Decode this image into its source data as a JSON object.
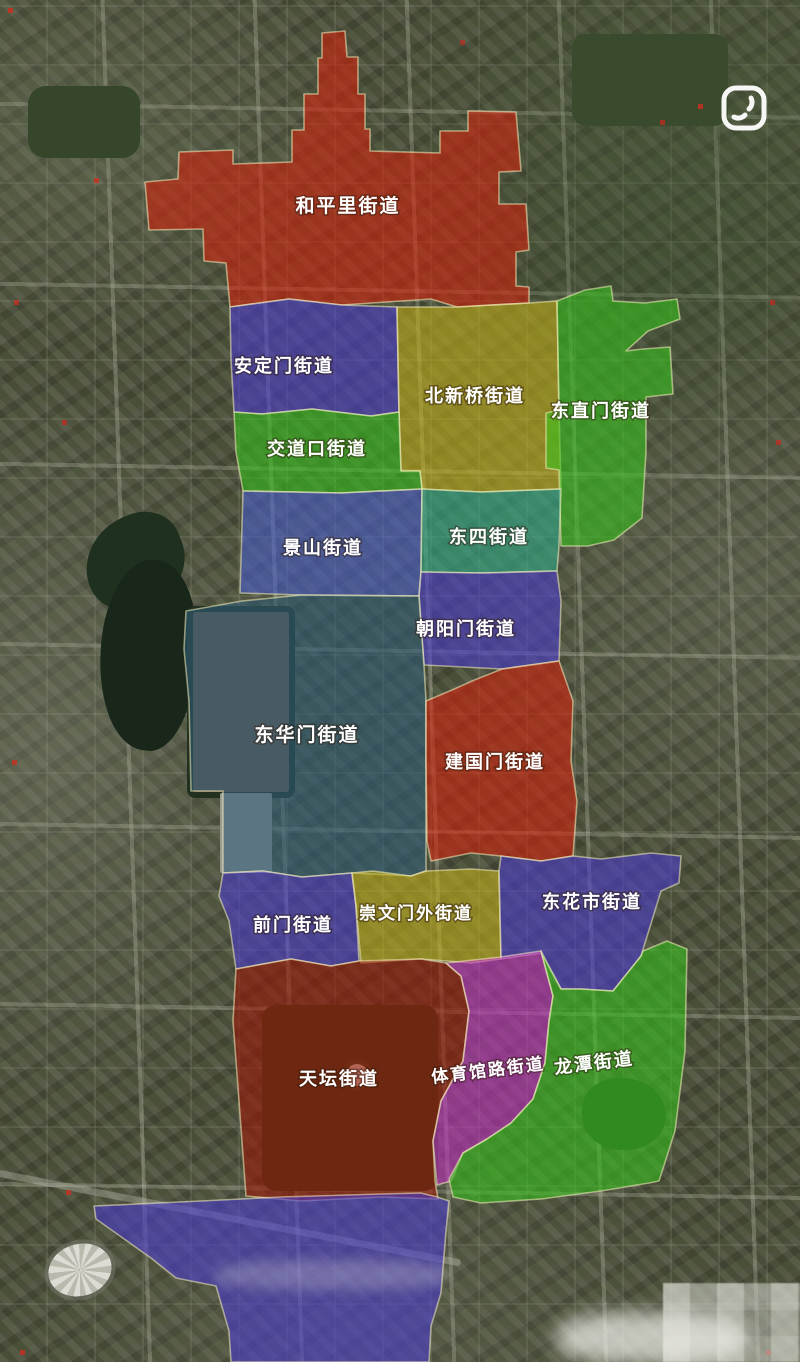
{
  "map": {
    "description_icons": {
      "watermark_icon": "rounded-square-hooks-icon"
    },
    "overlay_stroke": "#f5eec0",
    "districts": [
      {
        "id": "hepingli",
        "name": "和平里街道",
        "color": "#d5200a"
      },
      {
        "id": "andingmen",
        "name": "安定门街道",
        "color": "#4a3bd0"
      },
      {
        "id": "beixinqiao",
        "name": "北新桥街道",
        "color": "#c3b018"
      },
      {
        "id": "dongzhimen",
        "name": "东直门街道",
        "color": "#35c31c"
      },
      {
        "id": "jiaodaokou",
        "name": "交道口街道",
        "color": "#35c31c"
      },
      {
        "id": "jingshan",
        "name": "景山街道",
        "color": "#4a5fd0"
      },
      {
        "id": "dongsi",
        "name": "东四街道",
        "color": "#2fae8c"
      },
      {
        "id": "chaoyangmen",
        "name": "朝阳门街道",
        "color": "#4a3bd0"
      },
      {
        "id": "donghuamen",
        "name": "东华门街道",
        "color": "#2e5d78"
      },
      {
        "id": "jianguomen",
        "name": "建国门街道",
        "color": "#d5200a"
      },
      {
        "id": "qianmen",
        "name": "前门街道",
        "color": "#4a3bd0"
      },
      {
        "id": "chongwenmenwai",
        "name": "崇文门外街道",
        "color": "#c3b018"
      },
      {
        "id": "donghuashi",
        "name": "东花市街道",
        "color": "#4a3bd0"
      },
      {
        "id": "tiantan",
        "name": "天坛街道",
        "color": "#9c1505"
      },
      {
        "id": "tiyuguanlu",
        "name": "体育馆路街道",
        "color": "#c32ec3"
      },
      {
        "id": "longtan",
        "name": "龙潭街道",
        "color": "#35c31c"
      },
      {
        "id": "south-area",
        "name": "",
        "color": "#4a3bd0"
      }
    ]
  }
}
